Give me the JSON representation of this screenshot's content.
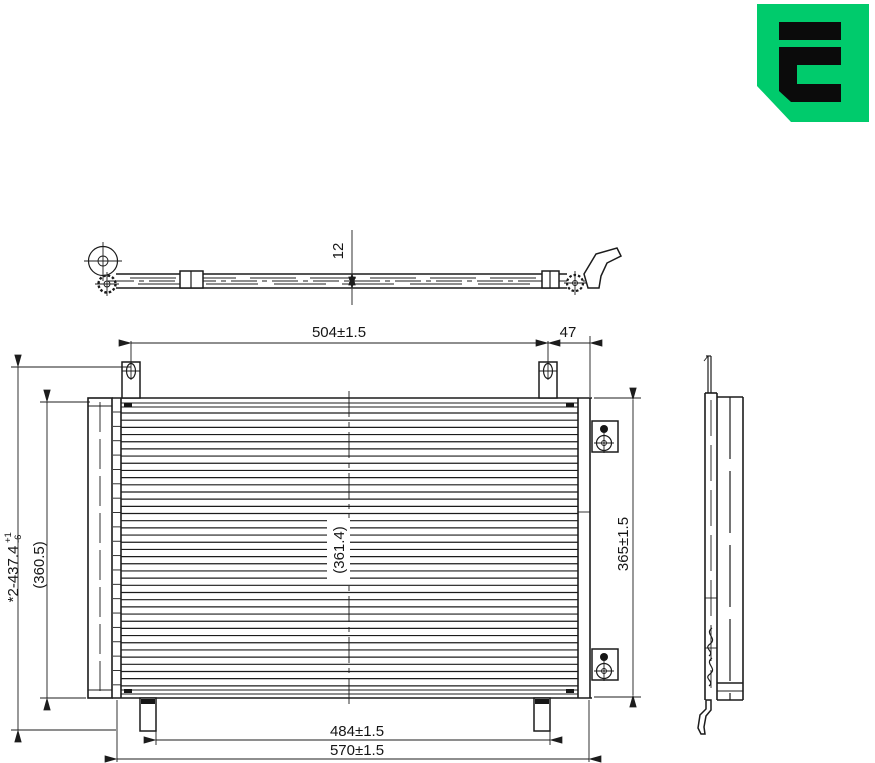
{
  "drawing": {
    "ink": "#1c1c1c",
    "type_label": "condenser-technical-drawing"
  },
  "logo": {
    "color": "#00CB6C",
    "glyph": "era-brand-mark"
  },
  "top_view": {
    "thickness_dim": "12"
  },
  "front_view": {
    "top_dims": {
      "tab_span": "504±1.5",
      "tab_to_edge": "47"
    },
    "left_dims": {
      "overall_height": "*2-437.4",
      "overall_height_tol_upper": "+1",
      "overall_height_tol_lower": "-6",
      "core_height": "(360.5)"
    },
    "center_dims": {
      "core_height_ref": "(361.4)"
    },
    "right_dims": {
      "height": "365±1.5"
    },
    "bottom_dims": {
      "peg_span": "484±1.5",
      "overall_width": "570±1.5"
    }
  }
}
